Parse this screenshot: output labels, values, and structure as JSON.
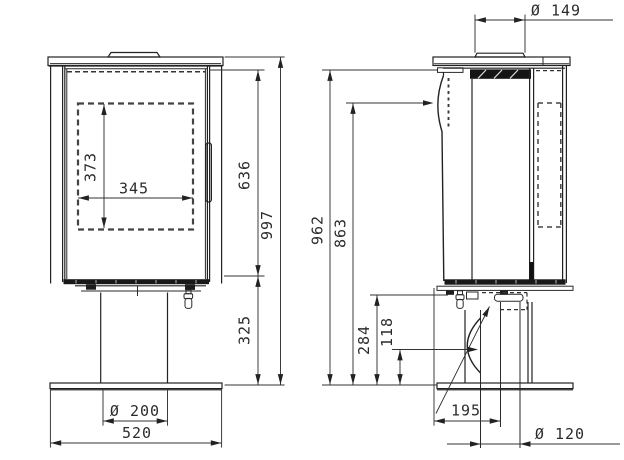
{
  "drawing": {
    "front_view": {
      "dimensions": {
        "glass_height": "373",
        "glass_width": "345",
        "body_height": "636",
        "pedestal_height": "325",
        "total_height": "997",
        "pedestal_diameter": "Ø 200",
        "base_width": "520"
      }
    },
    "side_view": {
      "dimensions": {
        "flue_collar_diameter": "Ø 149",
        "floor_to_body_top": "962",
        "floor_to_flue_center": "863",
        "floor_to_stove_bottom": "284",
        "air_inlet_center_height": "118",
        "rear_outlet_offset": "195",
        "rear_outlet_diameter": "Ø 120"
      }
    },
    "colors": {
      "line": "#222222",
      "dimension_line": "#333333",
      "text": "#2b2b2b",
      "background": "#ffffff"
    }
  }
}
